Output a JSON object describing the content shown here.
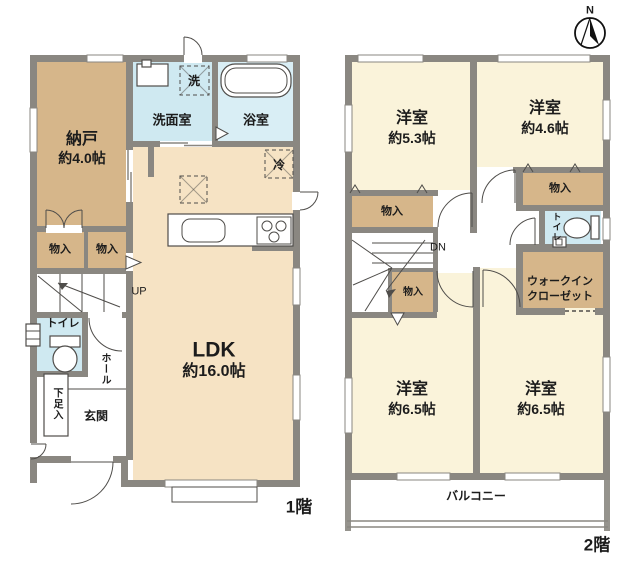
{
  "compass": {
    "label": "N"
  },
  "floor1": {
    "floor_label": "1階",
    "nando": {
      "name": "納戸",
      "size": "約4.0帖"
    },
    "senmenshitsu": "洗面室",
    "yokushitsu": "浴室",
    "washer_mark": "洗",
    "fridge_mark": "冷",
    "ldk": {
      "name": "LDK",
      "size": "約16.0帖"
    },
    "stairs_up": "UP",
    "closet_left": "物入",
    "closet_right": "物入",
    "toilet": "トイレ",
    "hall": "ホール",
    "shoe_cabinet": "下足入",
    "genkan": "玄関"
  },
  "floor2": {
    "floor_label": "2階",
    "room_53": {
      "name": "洋室",
      "size": "約5.3帖"
    },
    "room_46": {
      "name": "洋室",
      "size": "約4.6帖"
    },
    "room_65_left": {
      "name": "洋室",
      "size": "約6.5帖"
    },
    "room_65_right": {
      "name": "洋室",
      "size": "約6.5帖"
    },
    "closet_53": "物入",
    "closet_46": "物入",
    "closet_stairs": "物入",
    "toilet": "トイレ",
    "wic_line1": "ウォークイン",
    "wic_line2": "クローゼット",
    "stairs_down": "DN",
    "balcony": "バルコニー"
  },
  "colors": {
    "wall": "#8a8781",
    "wline": "#8a8781",
    "line": "#4f4d4a",
    "tan": "#d6b68a",
    "cream": "#f6e3c4",
    "yellow": "#faf3da",
    "blue": "#cfe9f1",
    "bath": "#d9eef5"
  }
}
